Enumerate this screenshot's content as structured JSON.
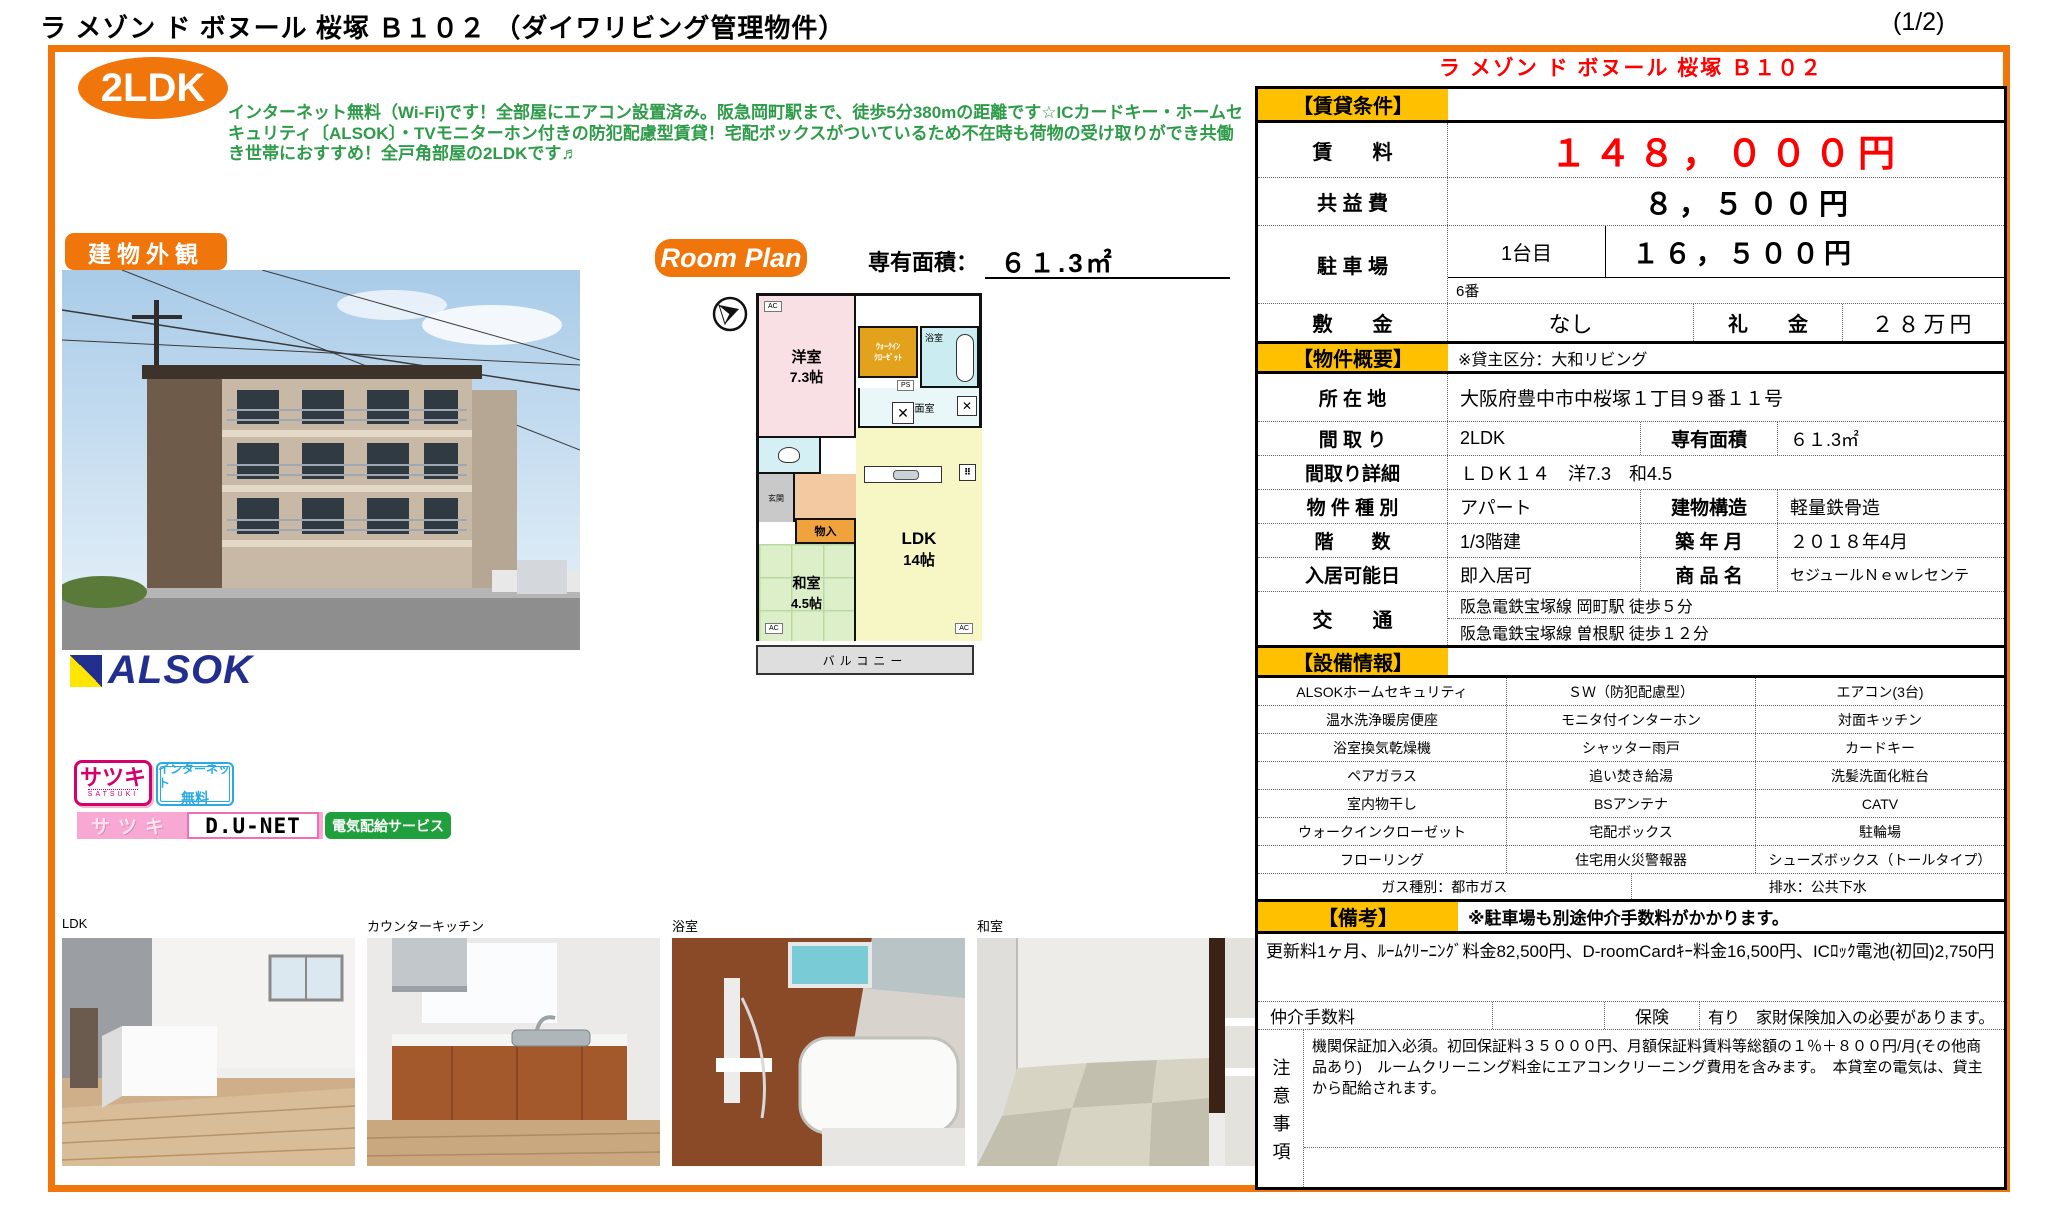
{
  "colors": {
    "accent_orange": "#F0750A",
    "header_yellow": "#FFC000",
    "price_red": "#FF0000",
    "desc_green": "#2E9B48"
  },
  "page": {
    "title": "ラ メゾン ド ボヌール 桜塚 Ｂ１０２ （ダイワリビング管理物件）",
    "page_number": "(1/2)"
  },
  "promo": {
    "type_badge": "2LDK",
    "description": "インターネット無料（Wi-Fi)です！全部屋にエアコン設置済み。阪急岡町駅まで、徒歩5分380mの距離です☆ICカードキー・ホームセキュリティ〔ALSOK〕・TVモニターホン付きの防犯配慮型賃貸！宅配ボックスがついているため不在時も荷物の受け取りができ共働き世帯におすすめ！全戸角部屋の2LDKです♬"
  },
  "property_name": "ラ メゾン ド ボヌール 桜塚 Ｂ１０２",
  "exterior_label": "建物外観",
  "room_plan": {
    "label": "Room Plan",
    "area_label": "専有面積：",
    "area_value": "６１.3㎡"
  },
  "floorplan": {
    "western_room": "洋室",
    "western_size": "7.3帖",
    "wic1": "ｳｫｰｸｲﾝ",
    "wic2": "ｸﾛｰｾﾞｯﾄ",
    "bath": "浴室",
    "washroom": "洗面室",
    "ps": "PS",
    "entrance": "玄関",
    "storage": "物入",
    "japanese_room": "和室",
    "japanese_size": "4.5帖",
    "ldk": "LDK",
    "ldk_size": "14帖",
    "balcony": "バルコニー",
    "ac": "AC"
  },
  "rental": {
    "section": "【賃貸条件】",
    "rent_label": "賃　　料",
    "rent_value": "１４８，０００円",
    "fee_label": "共 益 費",
    "fee_value": "８，５００円",
    "parking_label": "駐 車 場",
    "parking_unit": "1台目",
    "parking_value": "１６，５００円",
    "parking_number": "6番",
    "deposit_label": "敷　　金",
    "deposit_value": "なし",
    "key_money_label": "礼　　金",
    "key_money_value": "２８万円"
  },
  "overview": {
    "section": "【物件概要】",
    "owner_note": "※貸主区分：大和リビング",
    "location_label": "所 在 地",
    "location": "大阪府豊中市中桜塚１丁目９番１１号",
    "layout_label": "間 取 り",
    "layout": "2LDK",
    "area_label": "専有面積",
    "area": "６１.3㎡",
    "layout_detail_label": "間取り詳細",
    "layout_detail": "ＬＤＫ１４　洋7.3　和4.5",
    "type_label": "物 件 種 別",
    "type": "アパート",
    "structure_label": "建物構造",
    "structure": "軽量鉄骨造",
    "floors_label": "階　　数",
    "floors": "1/3階建",
    "built_label": "築 年 月",
    "built": "２０１８年4月",
    "movein_label": "入居可能日",
    "movein": "即入居可",
    "brand_label": "商 品 名",
    "brand": "セジュールＮｅｗレセンテ",
    "access_label": "交　　通",
    "access1": "阪急電鉄宝塚線 岡町駅 徒歩５分",
    "access2": "阪急電鉄宝塚線 曽根駅 徒歩１２分"
  },
  "equipment": {
    "section": "【設備情報】",
    "rows": [
      [
        "ALSOKホームセキュリティ",
        "ＳＷ（防犯配慮型）",
        "エアコン(3台)"
      ],
      [
        "温水洗浄暖房便座",
        "モニタ付インターホン",
        "対面キッチン"
      ],
      [
        "浴室換気乾燥機",
        "シャッター雨戸",
        "カードキー"
      ],
      [
        "ペアガラス",
        "追い焚き給湯",
        "洗髪洗面化粧台"
      ],
      [
        "室内物干し",
        "BSアンテナ",
        "CATV"
      ],
      [
        "ウォークインクローゼット",
        "宅配ボックス",
        "駐輪場"
      ],
      [
        "フローリング",
        "住宅用火災警報器",
        "シューズボックス（トールタイプ）"
      ]
    ],
    "gas": "ガス種別：都市ガス",
    "drain": "排水：公共下水"
  },
  "remarks": {
    "section": "【備考】",
    "note": "※駐車場も別途仲介手数料がかかります。",
    "renewal": "更新料1ヶ月、ﾙｰﾑｸﾘｰﾆﾝｸﾞ料金82,500円、D-roomCardｷｰ料金16,500円、ICﾛｯｸ電池(初回)2,750円",
    "agent_fee_label": "仲介手数料",
    "insurance_label": "保険",
    "insurance_value": "有り　家財保険加入の必要があります。",
    "caution_label": "注意事項",
    "caution_text": "機関保証加入必須。初回保証料３５０００円、月額保証料賃料等総額の１％＋８００円/月(その他商品あり)　ルームクリーニング料金にエアコンクリーニング費用を含みます。　本貸室の電気は、貸主から配給されます。"
  },
  "photos": {
    "labels": [
      "LDK",
      "カウンターキッチン",
      "浴室",
      "和室"
    ]
  },
  "logos": {
    "alsok": "ALSOK",
    "satsuki": "サツキ",
    "satsuki_sub": "SATSUKI",
    "internet_free1": "インターネット",
    "internet_free2": "無料",
    "satsuki_pink": "サツキ",
    "dunet": "D.U-NET",
    "denki": "電気配給サービス"
  }
}
